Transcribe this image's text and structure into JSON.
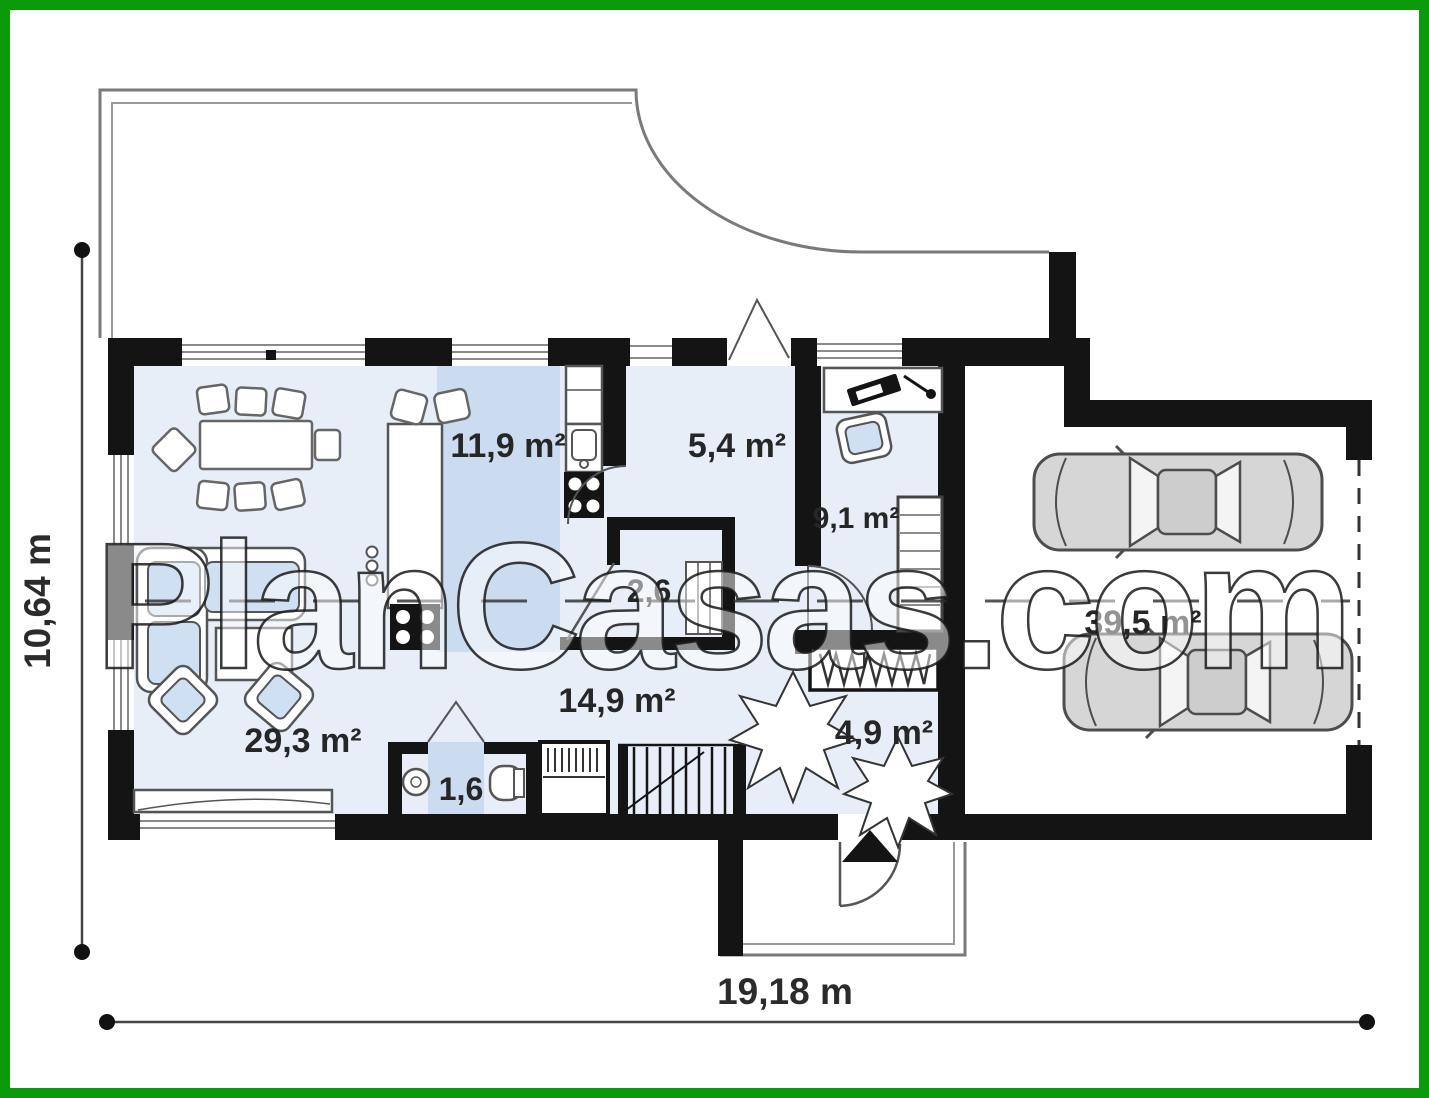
{
  "watermark": {
    "text": "PlanCasas.com"
  },
  "dimensions": {
    "height_label": "10,64 m",
    "width_label": "19,18 m"
  },
  "rooms": {
    "living_room": {
      "label": "29,3 m²"
    },
    "kitchen": {
      "label": "11,9 m²"
    },
    "corridor": {
      "label": "5,4 m²"
    },
    "office": {
      "label": "9,1 m²"
    },
    "pantry": {
      "label": "2,6"
    },
    "hall": {
      "label": "14,9 m²"
    },
    "wc": {
      "label": "1,6"
    },
    "vestibule": {
      "label": "4,9 m²"
    },
    "garage": {
      "label": "39,5 m²"
    }
  },
  "colors": {
    "frame_green": "#0a9a0a",
    "wall_black": "#141414",
    "room_fill": "#e7eef8",
    "accent_fill": "#ccdcf0",
    "furniture_blue": "#cfe0f2",
    "outline_gray": "#8a8a8a"
  }
}
